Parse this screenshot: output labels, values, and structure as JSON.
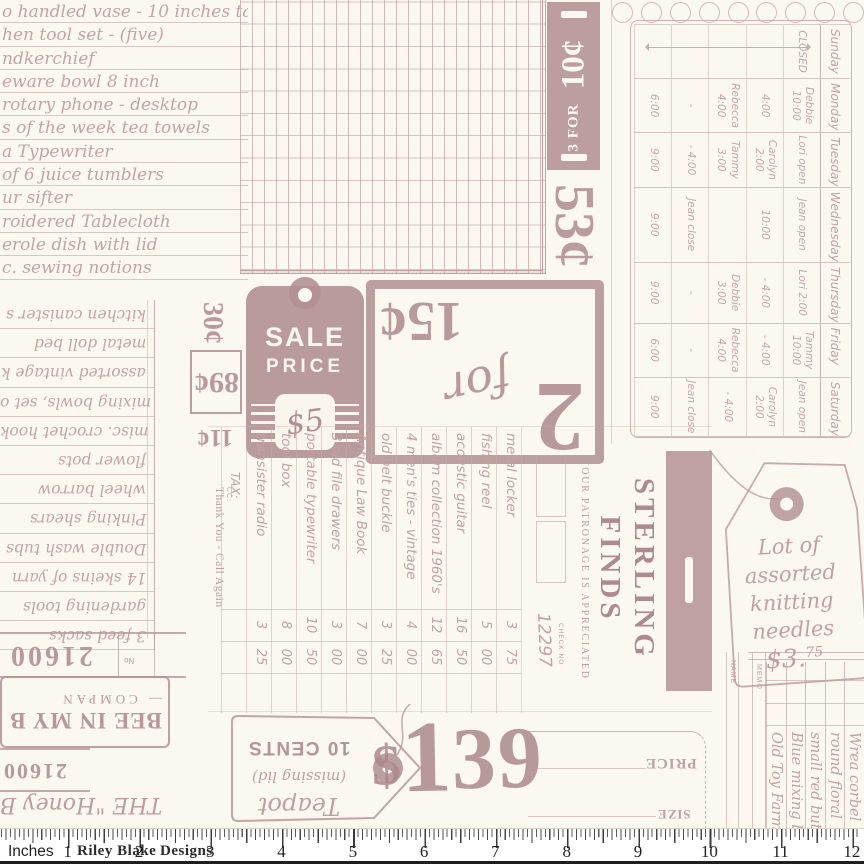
{
  "palette": {
    "background": "#fbf8ef",
    "ink": "#b18e91",
    "ink_light": "#c3a4a4",
    "ruler_bg": "#ffffff",
    "ruler_ink": "#222222"
  },
  "list_top_left": {
    "items": [
      "o handled vase - 10 inches tall",
      "hen tool set - (five)",
      "ndkerchief",
      "eware bowl 8 inch",
      "rotary phone - desktop",
      "s of the week tea towels",
      "a Typewriter",
      "of 6 juice tumblers",
      "ur sifter",
      "roidered Tablecloth",
      "erole dish with lid",
      "c. sewing notions"
    ]
  },
  "list_left_2": {
    "items": [
      "kitchen canister s",
      "metal doll bed",
      "assorted vintage k",
      "mixing bowls, set o",
      "misc. crochet hook",
      "flower pots",
      "wheel barrow",
      "Pinking shears",
      "Double wash tubs",
      "14 skeins of yarn",
      "gardening tools",
      "3 feed sacks"
    ]
  },
  "stamps": {
    "c30": "30¢",
    "c89": "89¢",
    "c11": "11¢",
    "c53": "53¢",
    "bar10": {
      "big": "10¢",
      "small": "3 FOR"
    },
    "sale_tag": {
      "l1": "SALE",
      "l2": "PRICE",
      "price": "$5"
    },
    "two_for": {
      "two": "2",
      "word": "for",
      "price": "15¢"
    },
    "price139": {
      "dollar": "$",
      "one": "1",
      "rest": "39"
    }
  },
  "schedule": {
    "days": [
      {
        "name": "Sunday",
        "cells": [
          "CLOSED",
          "",
          "",
          "",
          ""
        ]
      },
      {
        "name": "Monday",
        "cells": [
          "Debbie 10:00",
          "4:00",
          "Rebecca 4:00",
          "-",
          "6:00"
        ]
      },
      {
        "name": "Tuesday",
        "cells": [
          "Lori open",
          "Carolyn 2:00",
          "Tammy 3:00",
          "- 4:00",
          "9:00"
        ]
      },
      {
        "name": "Wednesday",
        "cells": [
          "Jean open",
          "10:00",
          "",
          "Jean close",
          "9:00"
        ]
      },
      {
        "name": "Thursday",
        "cells": [
          "Lori 2:00",
          "- 4:00",
          "Debbie 3:00",
          "-",
          "9:00"
        ]
      },
      {
        "name": "Friday",
        "cells": [
          "Tammy 10:00",
          "- 4:00",
          "Rebecca 4:00",
          "-",
          "6:00"
        ]
      },
      {
        "name": "Saturday",
        "cells": [
          "Jean open",
          "Carolyn 2:00",
          "- 4:00",
          "Jean close",
          "9:00"
        ]
      }
    ]
  },
  "receipt": {
    "brand1": "STERLING",
    "brand2": "FINDS",
    "patronage": "YOUR PATRONAGE IS APPRECIATED",
    "check_label": "CHECK NO",
    "check_no": "12297",
    "items": [
      {
        "n": "metal locker",
        "d": "3",
        "c": "75"
      },
      {
        "n": "fishing reel",
        "d": "5",
        "c": "00"
      },
      {
        "n": "acoustic guitar",
        "d": "16",
        "c": "50"
      },
      {
        "n": "album collection 1960's",
        "d": "12",
        "c": "65"
      },
      {
        "n": "4 men's ties - vintage",
        "d": "4",
        "c": "00"
      },
      {
        "n": "old belt buckle",
        "d": "3",
        "c": "25"
      },
      {
        "n": "Antique Law Book",
        "d": "7",
        "c": "00"
      },
      {
        "n": "3 old file drawers",
        "d": "3",
        "c": "00"
      },
      {
        "n": "portable typewriter",
        "d": "10",
        "c": "50"
      },
      {
        "n": "tool box",
        "d": "8",
        "c": "00"
      },
      {
        "n": "transister radio",
        "d": "3",
        "c": "25"
      }
    ],
    "tax": "TAX:",
    "cc": "CC:",
    "footer": "Thank You - Call Again"
  },
  "knitting_tag": {
    "l1": "Lot of",
    "l2": "assorted",
    "l3": "knitting",
    "l4": "needles",
    "price": "$3.",
    "cents": "75"
  },
  "teapot_tag": {
    "s1": "Teapot",
    "s2": "(missing lid)",
    "bold": "10 CENTS"
  },
  "stubs": {
    "number": "21600",
    "no_label": "No",
    "bee1": "BEE IN MY B",
    "bee2": "— COMPAN",
    "number2": "21600",
    "honey": "THE \"Honey B"
  },
  "price_size": {
    "price": "PRICE",
    "size": "SIZE"
  },
  "ledger_br": {
    "name": "NAME",
    "memo": "MEMO",
    "items": [
      "Old Toy Farm",
      "Blue mixing b",
      "small red butt",
      "round floral",
      "Wrea corbel"
    ]
  },
  "ruler": {
    "label": "Inches",
    "brand_a": "Riley Blake",
    "brand_b": "Designs",
    "numbers": [
      "1",
      "2",
      "3",
      "4",
      "5",
      "6",
      "7",
      "8",
      "9",
      "10",
      "11",
      "12"
    ]
  }
}
